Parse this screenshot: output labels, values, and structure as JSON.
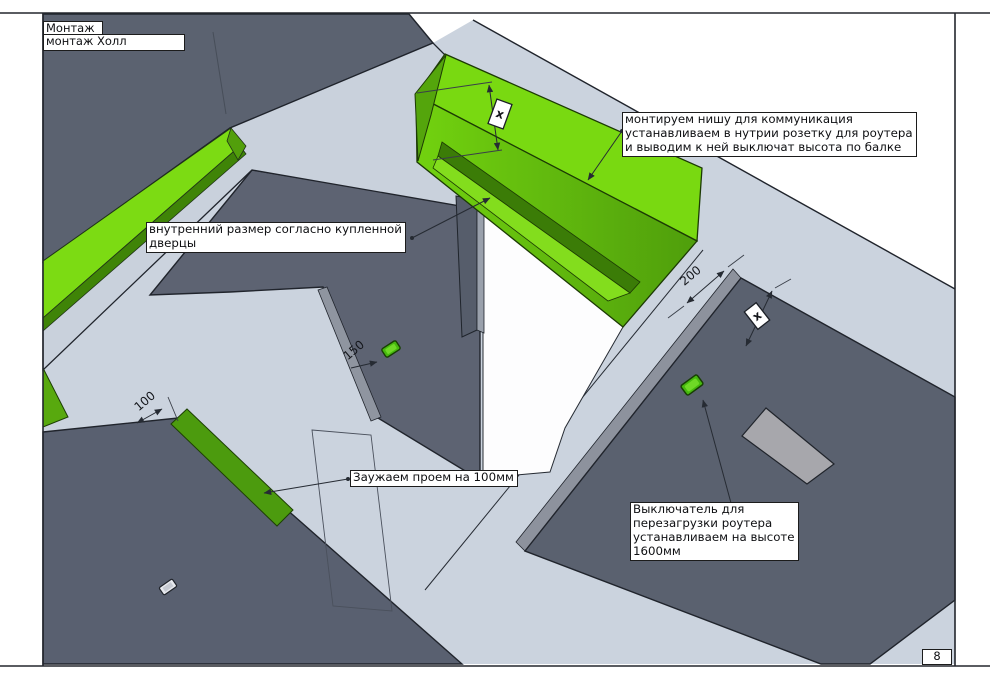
{
  "drawing": {
    "title": "Монтаж",
    "subtitle": "монтаж Холл",
    "page_number": "8"
  },
  "annotations": {
    "niche": {
      "lines": [
        "монтируем нишу для коммуникация",
        "устанавливаем в нутрии розетку для роутера",
        "и выводим к ней выключат высота по балке"
      ]
    },
    "inner_size": {
      "lines": [
        "внутренний размер согласно купленной",
        "дверцы"
      ]
    },
    "narrow": {
      "text": "Заужаем проем на 100мм"
    },
    "router_switch": {
      "lines": [
        "Выключатель для",
        "перезагрузки роутера",
        "устанавливаем на высоте",
        "1600мм"
      ]
    }
  },
  "dimensions": {
    "niche_depth": "200",
    "switch_offset": "150",
    "narrowing": "100",
    "x_marker_niche": "x",
    "x_marker_wall": "x"
  },
  "colors": {
    "accent_green_bright": "#79d911",
    "accent_green_dark": "#3b7c07",
    "wall_gray": "#5b6270",
    "surface_light": "#cbd3de",
    "panel_gray": "#a7a7ac"
  }
}
